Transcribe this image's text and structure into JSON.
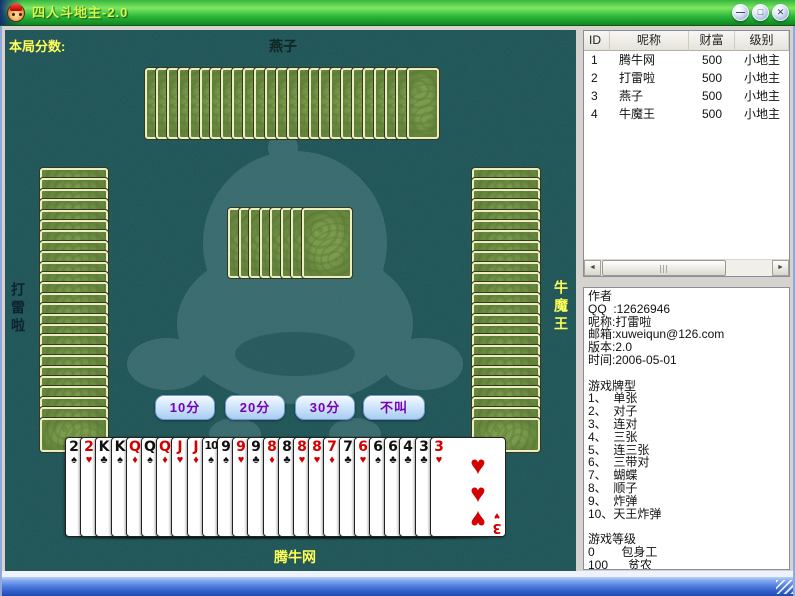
{
  "window": {
    "title": "四人斗地主-2.0",
    "controls": [
      {
        "name": "minimize",
        "glyph": "—"
      },
      {
        "name": "maximize",
        "glyph": "□"
      },
      {
        "name": "close",
        "glyph": "✕"
      }
    ]
  },
  "game": {
    "score_label": "本局分数:",
    "players": {
      "top": {
        "name": "燕子",
        "card_count": 25
      },
      "left": {
        "name": "打雷啦",
        "card_count": 25
      },
      "right": {
        "name": "牛魔王",
        "card_count": 25
      },
      "bottom": {
        "name": "腾牛网",
        "card_count": 25
      }
    },
    "kitty_card_count": 8,
    "bid_buttons": [
      "10分",
      "20分",
      "30分",
      "不叫"
    ],
    "hand": [
      {
        "rank": "2",
        "suit": "♠"
      },
      {
        "rank": "2",
        "suit": "♥"
      },
      {
        "rank": "K",
        "suit": "♣"
      },
      {
        "rank": "K",
        "suit": "♠"
      },
      {
        "rank": "Q",
        "suit": "♦"
      },
      {
        "rank": "Q",
        "suit": "♠"
      },
      {
        "rank": "Q",
        "suit": "♦"
      },
      {
        "rank": "J",
        "suit": "♥"
      },
      {
        "rank": "J",
        "suit": "♦"
      },
      {
        "rank": "10",
        "suit": "♠"
      },
      {
        "rank": "9",
        "suit": "♠"
      },
      {
        "rank": "9",
        "suit": "♥"
      },
      {
        "rank": "9",
        "suit": "♣"
      },
      {
        "rank": "8",
        "suit": "♦"
      },
      {
        "rank": "8",
        "suit": "♣"
      },
      {
        "rank": "8",
        "suit": "♥"
      },
      {
        "rank": "8",
        "suit": "♥"
      },
      {
        "rank": "7",
        "suit": "♦"
      },
      {
        "rank": "7",
        "suit": "♣"
      },
      {
        "rank": "6",
        "suit": "♥"
      },
      {
        "rank": "6",
        "suit": "♠"
      },
      {
        "rank": "6",
        "suit": "♣"
      },
      {
        "rank": "4",
        "suit": "♣"
      },
      {
        "rank": "3",
        "suit": "♣"
      },
      {
        "rank": "3",
        "suit": "♥"
      }
    ],
    "last_card_pip_count": 3
  },
  "roster": {
    "headers": [
      "ID",
      "呢称",
      "财富",
      "级别"
    ],
    "rows": [
      {
        "id": "1",
        "nick": "腾牛网",
        "wealth": "500",
        "level": "小地主"
      },
      {
        "id": "2",
        "nick": "打雷啦",
        "wealth": "500",
        "level": "小地主"
      },
      {
        "id": "3",
        "nick": "燕子",
        "wealth": "500",
        "level": "小地主"
      },
      {
        "id": "4",
        "nick": "牛魔王",
        "wealth": "500",
        "level": "小地主"
      }
    ]
  },
  "icons": {
    "scroll_left": "◄",
    "scroll_right": "►"
  },
  "info": {
    "lines": [
      "作者",
      "QQ  :12626946",
      "呢称:打雷啦",
      "邮箱:xuweiqun@126.com",
      "版本:2.0",
      "时间:2006-05-01",
      "",
      "游戏牌型",
      "1、  单张",
      "2、  对子",
      "3、  连对",
      "4、  三张",
      "5、  连三张",
      "6、  三带对",
      "7、  蝴蝶",
      "8、  顺子",
      "9、  炸弹",
      "10、天王炸弹",
      "",
      "游戏等级",
      "0        包身工",
      "100      贫农"
    ]
  },
  "colors": {
    "felt": "#2b6a6d",
    "card_back_green": "#7b9c4e",
    "card_border_cream": "#eeedc2",
    "bid_text_purple": "#7a00b8",
    "title_text": "#d6f94e",
    "label_yellow": "#ffff55",
    "red_suit": "#d40000"
  }
}
